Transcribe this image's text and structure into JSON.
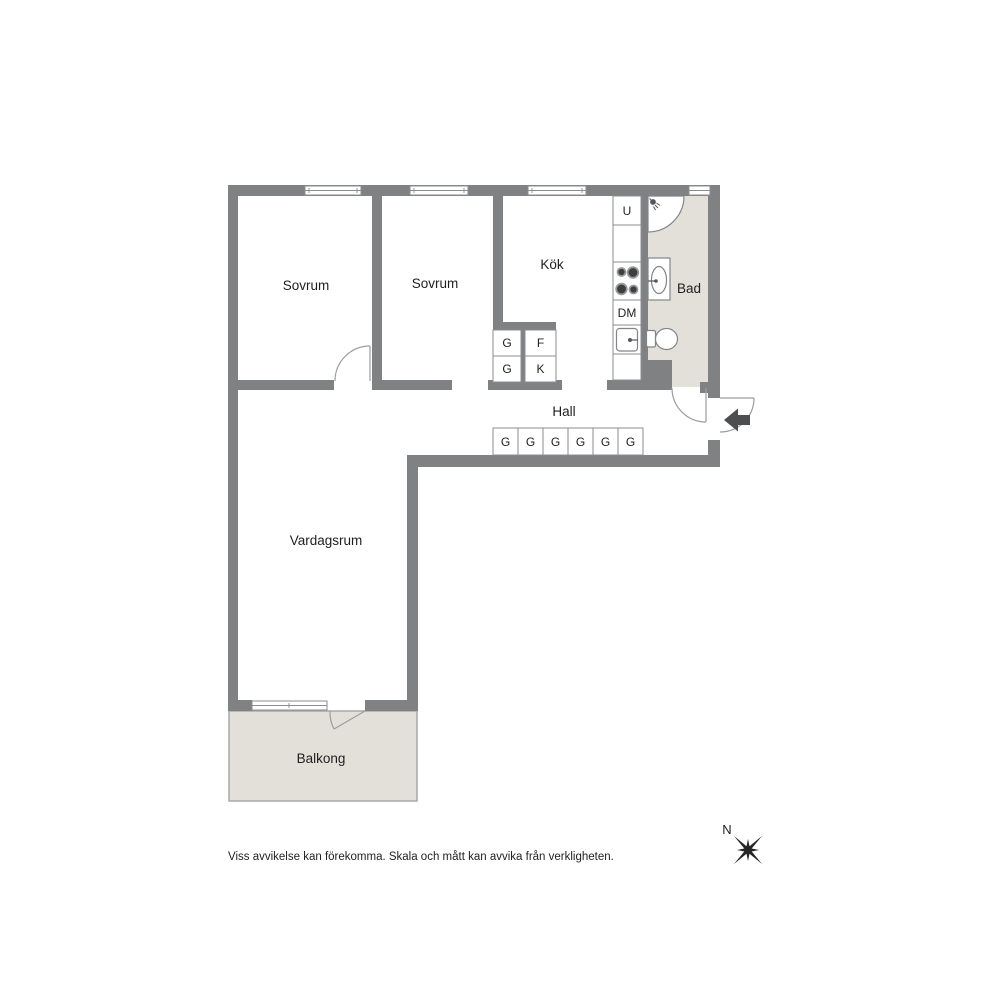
{
  "plan": {
    "rooms": [
      {
        "label": "Sovrum"
      },
      {
        "label": "Sovrum"
      },
      {
        "label": "Kök"
      },
      {
        "label": "Bad"
      },
      {
        "label": "Hall"
      },
      {
        "label": "Vardagsrum"
      },
      {
        "label": "Balkong"
      }
    ],
    "appliances": {
      "oven": "U",
      "dishwasher": "DM"
    },
    "cabinet_block": {
      "top_left": "G",
      "top_right": "F",
      "bottom_left": "G",
      "bottom_right": "K"
    },
    "hall_wardrobes": [
      "G",
      "G",
      "G",
      "G",
      "G",
      "G"
    ]
  },
  "compass": {
    "north": "N"
  },
  "footer": {
    "disclaimer": "Viss avvikelse kan förekomma. Skala och mått kan avvika från verkligheten."
  },
  "colors": {
    "wall": "#7f8183",
    "floor_accent": "#e3e0da",
    "fixture_stroke": "#8b8d90",
    "door_stroke": "#9b9da0",
    "stove_body": "#303234",
    "burner_ring": "#97999b",
    "burner_fill": "#3c3e40",
    "arrow": "#4c4e50",
    "compass": "#262626",
    "text": "#1f1f1f"
  }
}
